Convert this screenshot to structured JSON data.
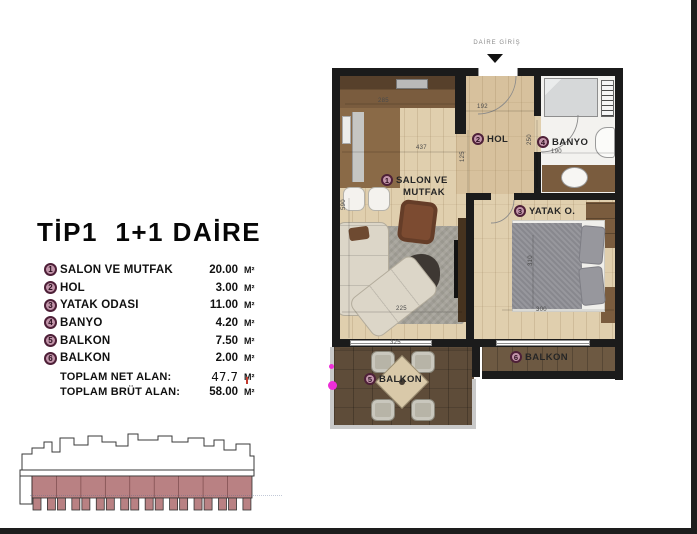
{
  "colors": {
    "wall": "#1b1b1b",
    "floor_wood": "#e0cfae",
    "bath_floor": "#f3f2ef",
    "cabinet_brown": "#7a5c3e",
    "deck_brown": "#5e4c39",
    "deck_brown_light": "#6d5942",
    "badge_fill": "#c295aa",
    "badge_ring": "#4e2038",
    "elevation_pink": "#b98183",
    "magenta_artifact": "#ee2ed8"
  },
  "title": "TİP1  1+1 DAİRE",
  "legend": {
    "rows": [
      {
        "num": "1",
        "label": "SALON VE MUTFAK",
        "value": "20.00",
        "unit": "M²"
      },
      {
        "num": "2",
        "label": "HOL",
        "value": "3.00",
        "unit": "M²"
      },
      {
        "num": "3",
        "label": "YATAK ODASI",
        "value": "11.00",
        "unit": "M²"
      },
      {
        "num": "4",
        "label": "BANYO",
        "value": "4.20",
        "unit": "M²"
      },
      {
        "num": "5",
        "label": "BALKON",
        "value": "7.50",
        "unit": "M²"
      },
      {
        "num": "6",
        "label": "BALKON",
        "value": "2.00",
        "unit": "M²"
      }
    ],
    "totals": [
      {
        "label": "TOPLAM NET ALAN:",
        "value": "47.7",
        "unit": "M²"
      },
      {
        "label": "TOPLAM BRÜT ALAN:",
        "value": "58.00",
        "unit": "M²"
      }
    ]
  },
  "plan": {
    "entrance_label": "DAİRE GİRİŞ",
    "rooms": [
      {
        "num": "1",
        "name": "SALON VE",
        "name2": "MUTFAK"
      },
      {
        "num": "2",
        "name": "HOL"
      },
      {
        "num": "3",
        "name": "YATAK O."
      },
      {
        "num": "4",
        "name": "BANYO"
      },
      {
        "num": "5",
        "name": "BALKON"
      },
      {
        "num": "6",
        "name": "BALKON"
      }
    ],
    "dimensions": [
      {
        "text": "285"
      },
      {
        "text": "437"
      },
      {
        "text": "125"
      },
      {
        "text": "192"
      },
      {
        "text": "250"
      },
      {
        "text": "190"
      },
      {
        "text": "590"
      },
      {
        "text": "225"
      },
      {
        "text": "310"
      },
      {
        "text": "300"
      },
      {
        "text": "325"
      }
    ]
  }
}
